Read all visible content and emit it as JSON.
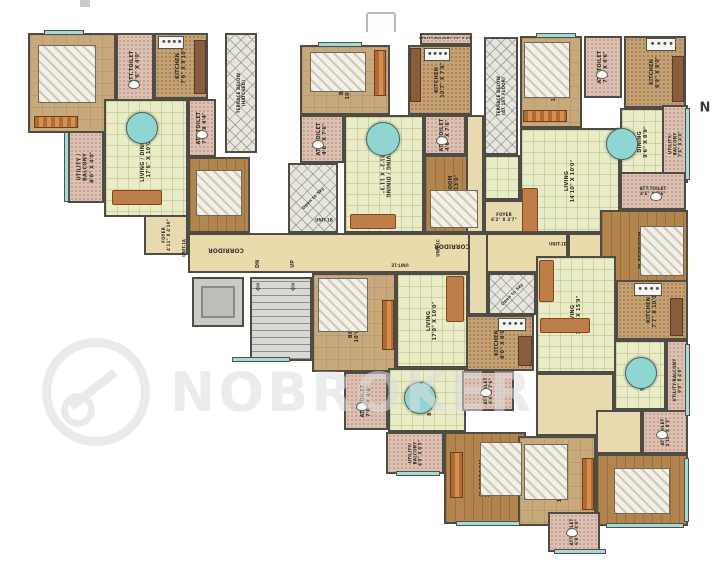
{
  "page": {
    "watermark_text": "NOBROKER",
    "compass_label": "N"
  },
  "floorplan": {
    "rooms": [
      {
        "id": "corridor",
        "unit": "core",
        "label": "",
        "kind": "cor",
        "x": 188,
        "y": 233,
        "w": 380,
        "h": 40,
        "rot": 0
      },
      {
        "id": "entry-1d",
        "unit": "1D",
        "label": "",
        "kind": "cor",
        "x": 568,
        "y": 233,
        "w": 50,
        "h": 25,
        "rot": 0
      },
      {
        "id": "bedroom-1a",
        "unit": "1A",
        "label": "BEDROOM\n12'0\" X 10'0\"",
        "kind": "bed",
        "x": 28,
        "y": 33,
        "w": 88,
        "h": 100,
        "rot": -90
      },
      {
        "id": "att-toilet-1a-1",
        "unit": "1A",
        "label": "ATT.TOILET\n7'6\" X 4'0\"",
        "kind": "wet",
        "x": 116,
        "y": 33,
        "w": 38,
        "h": 68,
        "rot": -90
      },
      {
        "id": "kitchen-1a",
        "unit": "1A",
        "label": "KITCHEN\n7'6\" X 9'10\"",
        "kind": "kit",
        "x": 154,
        "y": 33,
        "w": 54,
        "h": 66,
        "rot": -90
      },
      {
        "id": "terrace-hatched",
        "unit": "1A",
        "label": "TERRACE BELOW\n(HATCHED)",
        "kind": "hatch",
        "x": 225,
        "y": 33,
        "w": 32,
        "h": 120,
        "rot": -90,
        "fs": 4
      },
      {
        "id": "living-dining-1a",
        "unit": "1A",
        "label": "LIVING / DINING\n17'6\" X 10'0\"",
        "kind": "liv",
        "x": 104,
        "y": 99,
        "w": 84,
        "h": 118,
        "rot": -90
      },
      {
        "id": "utility-balcony-1a",
        "unit": "1A",
        "label": "UTILITY /\nBALCONY\n8'0\" X 4'0\"",
        "kind": "wet",
        "x": 68,
        "y": 131,
        "w": 36,
        "h": 72,
        "rot": -90
      },
      {
        "id": "att-toilet-1a-2",
        "unit": "1A",
        "label": "ATT.TOILET\n7'4\" X 4'4\"",
        "kind": "wet",
        "x": 188,
        "y": 99,
        "w": 28,
        "h": 58,
        "rot": -90
      },
      {
        "id": "m-bedroom-1a",
        "unit": "1A",
        "label": "M.BEDROOM\n10'0\" X 11'0\"",
        "kind": "mbed",
        "x": 188,
        "y": 157,
        "w": 62,
        "h": 76,
        "rot": -90
      },
      {
        "id": "foyer-1a",
        "unit": "1A",
        "label": "FOYER\n4'11\" X 4'10\"",
        "kind": "hall",
        "x": 144,
        "y": 215,
        "w": 44,
        "h": 40,
        "rot": -90,
        "fs": 4
      },
      {
        "id": "lift",
        "unit": "core",
        "label": "LIFT",
        "kind": "lift",
        "x": 192,
        "y": 277,
        "w": 52,
        "h": 50,
        "rot": -90,
        "fs": 6
      },
      {
        "id": "staircase",
        "unit": "core",
        "label": "",
        "kind": "stair",
        "x": 250,
        "y": 277,
        "w": 62,
        "h": 84,
        "rot": 0
      },
      {
        "id": "bedroom-1b",
        "unit": "1B",
        "label": "BEDROOM\n10'0\" X 10'6\"",
        "kind": "bed",
        "x": 300,
        "y": 45,
        "w": 90,
        "h": 70,
        "rot": -90
      },
      {
        "id": "att-toilet-1b-1",
        "unit": "1B",
        "label": "ATT.TOILET\n4'6\" X 7'6\"",
        "kind": "wet",
        "x": 300,
        "y": 115,
        "w": 44,
        "h": 48,
        "rot": -90
      },
      {
        "id": "open-to-sky-1b",
        "unit": "1B",
        "label": "Open to Sky",
        "kind": "hatch",
        "x": 288,
        "y": 163,
        "w": 50,
        "h": 70,
        "rot": -45,
        "fs": 4
      },
      {
        "id": "living-dining-1b",
        "unit": "1B",
        "label": "LIVING / DINING\n21'2\" X 11'3\"",
        "kind": "liv",
        "x": 344,
        "y": 115,
        "w": 80,
        "h": 118,
        "rot": 90
      },
      {
        "id": "utility-balcony-1b",
        "unit": "1B",
        "label": "UTILITY/BALCONY 4'0\" X 9'0\"",
        "kind": "wet",
        "x": 420,
        "y": 33,
        "w": 52,
        "h": 12,
        "rot": 0,
        "fs": 3
      },
      {
        "id": "kitchen-1b",
        "unit": "1B",
        "label": "KITCHEN\n10'7\" X 7'6\"",
        "kind": "kit",
        "x": 408,
        "y": 45,
        "w": 64,
        "h": 70,
        "rot": -90
      },
      {
        "id": "att-toilet-1b-2",
        "unit": "1B",
        "label": "ATT.TOILET\n4'6\" X 7'6\"",
        "kind": "wet",
        "x": 424,
        "y": 115,
        "w": 42,
        "h": 40,
        "rot": -90
      },
      {
        "id": "m-bedroom-1b",
        "unit": "1B",
        "label": "M.BEDROOM\n10'0\" X 13'0\"",
        "kind": "mbed",
        "x": 424,
        "y": 155,
        "w": 60,
        "h": 78,
        "rot": -90
      },
      {
        "id": "terrace-1st-floor",
        "unit": "1B",
        "label": "TERRACE BELOW\n(AT 1ST FLOOR)",
        "kind": "hatch",
        "x": 484,
        "y": 37,
        "w": 34,
        "h": 118,
        "rot": -90,
        "fs": 4
      },
      {
        "id": "passage-1c-a",
        "unit": "1C",
        "label": "",
        "kind": "hall",
        "x": 466,
        "y": 115,
        "w": 18,
        "h": 118,
        "rot": 0
      },
      {
        "id": "passage-1c-b",
        "unit": "1C",
        "label": "",
        "kind": "liv",
        "x": 484,
        "y": 155,
        "w": 36,
        "h": 45,
        "rot": 0
      },
      {
        "id": "bedroom-1c",
        "unit": "1C",
        "label": "BEDROOM\n10'6\" X 10'0\"",
        "kind": "bed",
        "x": 520,
        "y": 36,
        "w": 62,
        "h": 92,
        "rot": -90
      },
      {
        "id": "att-toilet-1c-1",
        "unit": "1C",
        "label": "ATT.TOILET\n7'6\" X 4'6\"",
        "kind": "wet",
        "x": 584,
        "y": 36,
        "w": 38,
        "h": 62,
        "rot": -90
      },
      {
        "id": "kitchen-1c",
        "unit": "1C",
        "label": "KITCHEN\n6'9\" X 8'0\"",
        "kind": "kit",
        "x": 624,
        "y": 36,
        "w": 62,
        "h": 72,
        "rot": -90
      },
      {
        "id": "dining-1c",
        "unit": "1C",
        "label": "DINING\n9'6\" X 8'9\"",
        "kind": "liv",
        "x": 620,
        "y": 108,
        "w": 46,
        "h": 68,
        "rot": -90
      },
      {
        "id": "living-1c",
        "unit": "1C",
        "label": "LIVING\n14'10\" X 10'0\"",
        "kind": "liv",
        "x": 520,
        "y": 128,
        "w": 100,
        "h": 105,
        "rot": -90
      },
      {
        "id": "utility-balcony-1c",
        "unit": "1C",
        "label": "UTILITY/\nBALCONY\n7'6\" X 4'0\"",
        "kind": "wet",
        "x": 662,
        "y": 105,
        "w": 26,
        "h": 78,
        "rot": -90,
        "fs": 4
      },
      {
        "id": "att-toilet-1c-2",
        "unit": "1C",
        "label": "ATT.TOILET\n4'6\" X 7'6\"",
        "kind": "wet",
        "x": 620,
        "y": 172,
        "w": 66,
        "h": 38,
        "rot": 0,
        "fs": 4
      },
      {
        "id": "m-bedroom-1c",
        "unit": "1C",
        "label": "M.BEDROOM\n10'1\" X 10'0\"",
        "kind": "mbed",
        "x": 600,
        "y": 210,
        "w": 88,
        "h": 80,
        "rot": -90
      },
      {
        "id": "foyer-1c",
        "unit": "1C",
        "label": "FOYER\n6'2\" X 3'7\"",
        "kind": "hall",
        "x": 484,
        "y": 200,
        "w": 40,
        "h": 33,
        "rot": 0,
        "fs": 4
      },
      {
        "id": "bedroom-1e",
        "unit": "1E",
        "label": "BEDROOM\n10'0\" X 10'0\"",
        "kind": "bed",
        "x": 312,
        "y": 273,
        "w": 84,
        "h": 99,
        "rot": -90
      },
      {
        "id": "living-1e",
        "unit": "1E",
        "label": "LIVING\n17'0\" X 10'0\"",
        "kind": "liv",
        "x": 396,
        "y": 273,
        "w": 72,
        "h": 95,
        "rot": -90
      },
      {
        "id": "att-toilet-1e-1",
        "unit": "1E",
        "label": "ATT.TOILET\n7'6\" X 4'4\"",
        "kind": "wet",
        "x": 344,
        "y": 372,
        "w": 44,
        "h": 58,
        "rot": -90
      },
      {
        "id": "dining-1e",
        "unit": "1E",
        "label": "DINING\n8'1\" X 8'5\"",
        "kind": "liv",
        "x": 388,
        "y": 368,
        "w": 78,
        "h": 64,
        "rot": -90
      },
      {
        "id": "utility-balcony-1e",
        "unit": "1E",
        "label": "UTILITY/\nBALCONY\n4'0\" X 8'5\"",
        "kind": "wet",
        "x": 386,
        "y": 432,
        "w": 58,
        "h": 42,
        "rot": -90,
        "fs": 4
      },
      {
        "id": "kitchen-1e",
        "unit": "1E",
        "label": "KITCHEN\n8'0\" X 8'0\"",
        "kind": "kit",
        "x": 466,
        "y": 315,
        "w": 68,
        "h": 56,
        "rot": -90
      },
      {
        "id": "att-toilet-1e-2",
        "unit": "1E",
        "label": "ATT.TOILET\n6'6\" X 7'6\"",
        "kind": "wet",
        "x": 462,
        "y": 371,
        "w": 52,
        "h": 40,
        "rot": -90,
        "fs": 4
      },
      {
        "id": "m-bedroom-1e",
        "unit": "1E",
        "label": "M.BEDROOM\n12'0\" X 10'0\"",
        "kind": "mbed",
        "x": 444,
        "y": 432,
        "w": 82,
        "h": 92,
        "rot": -90
      },
      {
        "id": "entry-1e",
        "unit": "1E",
        "label": "",
        "kind": "hall",
        "x": 468,
        "y": 233,
        "w": 20,
        "h": 82,
        "rot": 0
      },
      {
        "id": "open-to-sky-1d",
        "unit": "1D",
        "label": "Open to Sky",
        "kind": "hatch",
        "x": 488,
        "y": 273,
        "w": 48,
        "h": 42,
        "rot": -45,
        "fs": 4
      },
      {
        "id": "living-1d",
        "unit": "1D",
        "label": "LIVING\n10'7\" X 15'9\"",
        "kind": "liv",
        "x": 536,
        "y": 256,
        "w": 80,
        "h": 117,
        "rot": -90
      },
      {
        "id": "kitchen-1d",
        "unit": "1D",
        "label": "KITCHEN\n7'7\" X 10'0\"",
        "kind": "kit",
        "x": 616,
        "y": 280,
        "w": 72,
        "h": 60,
        "rot": -90
      },
      {
        "id": "dining-1d",
        "unit": "1D",
        "label": "DINING\n9'6\" X 8'9\"",
        "kind": "liv",
        "x": 614,
        "y": 340,
        "w": 52,
        "h": 70,
        "rot": -90
      },
      {
        "id": "utility-balcony-1d",
        "unit": "1D",
        "label": "UTILITY/BALCONY\n9'0\" X 4'0\"",
        "kind": "wet",
        "x": 666,
        "y": 340,
        "w": 22,
        "h": 80,
        "rot": -90,
        "fs": 4
      },
      {
        "id": "passage-1d",
        "unit": "1D",
        "label": "",
        "kind": "hall",
        "x": 536,
        "y": 373,
        "w": 78,
        "h": 63,
        "rot": 0
      },
      {
        "id": "passage-1d-b",
        "unit": "1D",
        "label": "",
        "kind": "hall",
        "x": 596,
        "y": 410,
        "w": 46,
        "h": 44,
        "rot": 0
      },
      {
        "id": "att-toilet-1d-1",
        "unit": "1D",
        "label": "ATT.TOILET\n4'10\" X 8'3\"",
        "kind": "wet",
        "x": 642,
        "y": 410,
        "w": 46,
        "h": 44,
        "rot": -90,
        "fs": 4
      },
      {
        "id": "bedroom-1d",
        "unit": "1D",
        "label": "BEDROOM\n12'0\" X 10'10\"",
        "kind": "bed",
        "x": 518,
        "y": 436,
        "w": 78,
        "h": 90,
        "rot": -90
      },
      {
        "id": "m-bedroom-1d",
        "unit": "1D",
        "label": "M.BEDROOM\n13'8\" X 10'0\"",
        "kind": "mbed",
        "x": 596,
        "y": 454,
        "w": 92,
        "h": 72,
        "rot": -90
      },
      {
        "id": "att-toilet-1d-2",
        "unit": "1D",
        "label": "ATT.TOILET\n6'9\" X 4'0\"",
        "kind": "wet",
        "x": 548,
        "y": 512,
        "w": 52,
        "h": 40,
        "rot": -90,
        "fs": 4
      }
    ],
    "furniture": [
      {
        "type": "bed",
        "x": 38,
        "y": 45,
        "w": 58,
        "h": 58
      },
      {
        "type": "ward",
        "x": 34,
        "y": 116,
        "w": 44,
        "h": 12
      },
      {
        "type": "counter",
        "x": 194,
        "y": 40,
        "w": 12,
        "h": 54
      },
      {
        "type": "stove",
        "x": 158,
        "y": 36,
        "w": 26,
        "h": 13
      },
      {
        "type": "table",
        "x": 126,
        "y": 112,
        "w": 32,
        "h": 32
      },
      {
        "type": "sofa",
        "x": 112,
        "y": 190,
        "w": 50,
        "h": 15
      },
      {
        "type": "bed",
        "x": 196,
        "y": 170,
        "w": 46,
        "h": 46
      },
      {
        "type": "bed",
        "x": 310,
        "y": 52,
        "w": 56,
        "h": 40
      },
      {
        "type": "ward",
        "x": 374,
        "y": 50,
        "w": 12,
        "h": 46
      },
      {
        "type": "table",
        "x": 366,
        "y": 122,
        "w": 34,
        "h": 34
      },
      {
        "type": "sofa",
        "x": 350,
        "y": 214,
        "w": 46,
        "h": 15
      },
      {
        "type": "stove",
        "x": 424,
        "y": 48,
        "w": 26,
        "h": 13
      },
      {
        "type": "counter",
        "x": 410,
        "y": 48,
        "w": 11,
        "h": 54
      },
      {
        "type": "bed",
        "x": 430,
        "y": 190,
        "w": 48,
        "h": 38
      },
      {
        "type": "bed",
        "x": 524,
        "y": 42,
        "w": 46,
        "h": 56
      },
      {
        "type": "ward",
        "x": 523,
        "y": 110,
        "w": 44,
        "h": 12
      },
      {
        "type": "stove",
        "x": 646,
        "y": 38,
        "w": 30,
        "h": 13
      },
      {
        "type": "counter",
        "x": 672,
        "y": 56,
        "w": 12,
        "h": 46
      },
      {
        "type": "table",
        "x": 606,
        "y": 128,
        "w": 32,
        "h": 32
      },
      {
        "type": "sofa",
        "x": 522,
        "y": 188,
        "w": 16,
        "h": 44
      },
      {
        "type": "bed",
        "x": 640,
        "y": 226,
        "w": 44,
        "h": 50
      },
      {
        "type": "bed",
        "x": 318,
        "y": 278,
        "w": 50,
        "h": 54
      },
      {
        "type": "ward",
        "x": 382,
        "y": 300,
        "w": 12,
        "h": 50
      },
      {
        "type": "sofa",
        "x": 446,
        "y": 276,
        "w": 18,
        "h": 46
      },
      {
        "type": "table",
        "x": 404,
        "y": 382,
        "w": 32,
        "h": 32
      },
      {
        "type": "stove",
        "x": 498,
        "y": 318,
        "w": 28,
        "h": 13
      },
      {
        "type": "counter",
        "x": 518,
        "y": 336,
        "w": 14,
        "h": 30
      },
      {
        "type": "bed",
        "x": 480,
        "y": 442,
        "w": 42,
        "h": 54
      },
      {
        "type": "ward",
        "x": 450,
        "y": 452,
        "w": 13,
        "h": 46
      },
      {
        "type": "sofa",
        "x": 540,
        "y": 318,
        "w": 50,
        "h": 15
      },
      {
        "type": "sofa",
        "x": 539,
        "y": 260,
        "w": 15,
        "h": 42
      },
      {
        "type": "table",
        "x": 625,
        "y": 357,
        "w": 32,
        "h": 32
      },
      {
        "type": "stove",
        "x": 634,
        "y": 283,
        "w": 28,
        "h": 13
      },
      {
        "type": "counter",
        "x": 670,
        "y": 298,
        "w": 13,
        "h": 38
      },
      {
        "type": "bed",
        "x": 614,
        "y": 468,
        "w": 56,
        "h": 46
      },
      {
        "type": "bed",
        "x": 524,
        "y": 444,
        "w": 44,
        "h": 56
      },
      {
        "type": "ward",
        "x": 582,
        "y": 458,
        "w": 12,
        "h": 52
      },
      {
        "type": "wc",
        "x": 128,
        "y": 80,
        "w": 12,
        "h": 9
      },
      {
        "type": "wc",
        "x": 196,
        "y": 130,
        "w": 12,
        "h": 9
      },
      {
        "type": "wc",
        "x": 312,
        "y": 140,
        "w": 12,
        "h": 9
      },
      {
        "type": "wc",
        "x": 436,
        "y": 136,
        "w": 12,
        "h": 9
      },
      {
        "type": "wc",
        "x": 596,
        "y": 70,
        "w": 12,
        "h": 9
      },
      {
        "type": "wc",
        "x": 650,
        "y": 192,
        "w": 12,
        "h": 9
      },
      {
        "type": "wc",
        "x": 356,
        "y": 402,
        "w": 12,
        "h": 9
      },
      {
        "type": "wc",
        "x": 480,
        "y": 388,
        "w": 12,
        "h": 9
      },
      {
        "type": "wc",
        "x": 656,
        "y": 430,
        "w": 12,
        "h": 9
      },
      {
        "type": "wc",
        "x": 566,
        "y": 528,
        "w": 12,
        "h": 9
      }
    ],
    "windows": [
      {
        "x": 64,
        "y": 132,
        "w": 5,
        "h": 70
      },
      {
        "x": 44,
        "y": 30,
        "w": 40,
        "h": 5
      },
      {
        "x": 318,
        "y": 42,
        "w": 44,
        "h": 5
      },
      {
        "x": 536,
        "y": 33,
        "w": 40,
        "h": 5
      },
      {
        "x": 685,
        "y": 108,
        "w": 5,
        "h": 72
      },
      {
        "x": 685,
        "y": 344,
        "w": 5,
        "h": 72
      },
      {
        "x": 684,
        "y": 458,
        "w": 5,
        "h": 64
      },
      {
        "x": 396,
        "y": 471,
        "w": 44,
        "h": 5
      },
      {
        "x": 456,
        "y": 521,
        "w": 64,
        "h": 5
      },
      {
        "x": 554,
        "y": 549,
        "w": 52,
        "h": 5
      },
      {
        "x": 606,
        "y": 523,
        "w": 78,
        "h": 5
      },
      {
        "x": 232,
        "y": 357,
        "w": 58,
        "h": 5
      }
    ],
    "annotations": [
      {
        "text": "CORRIDOR",
        "x": 226,
        "y": 250,
        "rot": 180,
        "size": 6
      },
      {
        "text": "CORRIDOR",
        "x": 452,
        "y": 246,
        "rot": 180,
        "size": 6
      },
      {
        "text": "DN",
        "x": 258,
        "y": 264,
        "rot": -90,
        "size": 5
      },
      {
        "text": "UP",
        "x": 293,
        "y": 264,
        "rot": -90,
        "size": 5
      },
      {
        "text": "⇩",
        "x": 258,
        "y": 288,
        "rot": 0,
        "size": 10
      },
      {
        "text": "⇩",
        "x": 293,
        "y": 288,
        "rot": 0,
        "size": 10
      },
      {
        "text": "UNIT-1A",
        "x": 184,
        "y": 248,
        "rot": -90,
        "size": 4
      },
      {
        "text": "UNIT-1B",
        "x": 324,
        "y": 220,
        "rot": 0,
        "size": 4
      },
      {
        "text": "UNIT-1C",
        "x": 438,
        "y": 248,
        "rot": -90,
        "size": 4
      },
      {
        "text": "UNIT-1D",
        "x": 558,
        "y": 244,
        "rot": 0,
        "size": 4
      },
      {
        "text": "UNIT-1E",
        "x": 400,
        "y": 265,
        "rot": 180,
        "size": 4
      },
      {
        "text": "N",
        "x": 705,
        "y": 108,
        "rot": 0,
        "size": 13
      }
    ]
  }
}
